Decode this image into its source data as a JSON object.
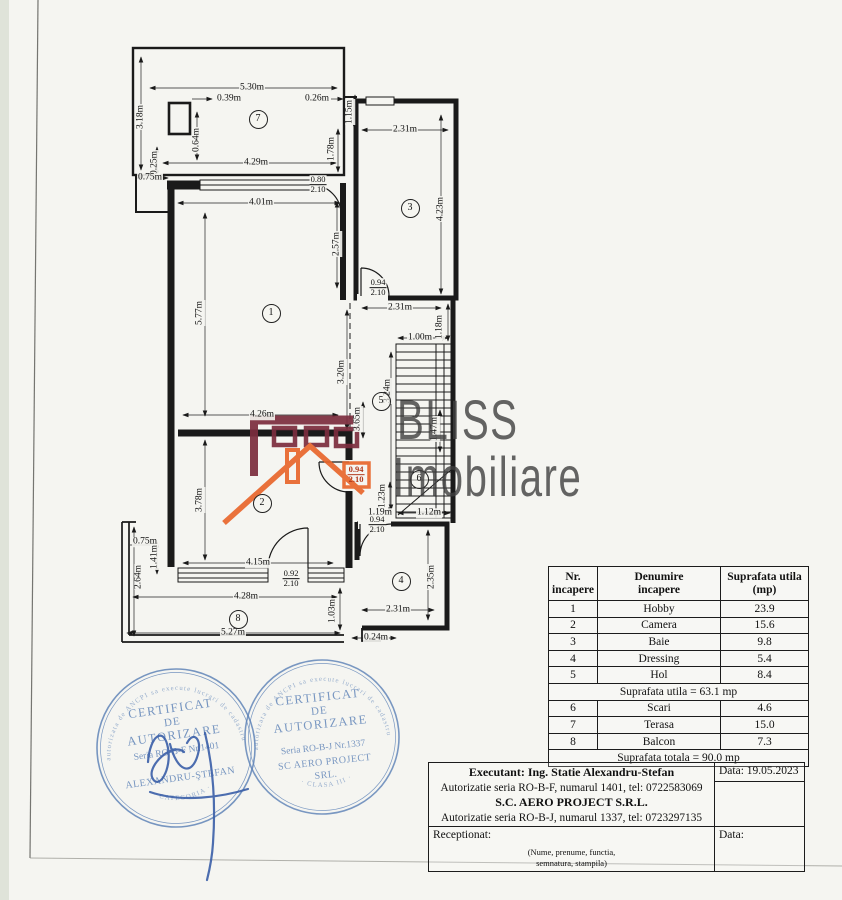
{
  "colors": {
    "ink": "#1a1a1a",
    "paper": "#f5f5f1",
    "maroon": "#7c2d3e",
    "orange": "#e8662c",
    "blue": "#5b80b6",
    "signature": "#3a5fa8"
  },
  "watermark": {
    "line1": "BLISS",
    "line2": "Imobiliare"
  },
  "plan": {
    "rooms": [
      {
        "n": "1",
        "x": 270,
        "y": 312
      },
      {
        "n": "2",
        "x": 261,
        "y": 502
      },
      {
        "n": "3",
        "x": 409,
        "y": 207
      },
      {
        "n": "4",
        "x": 400,
        "y": 580
      },
      {
        "n": "5",
        "x": 380,
        "y": 400
      },
      {
        "n": "6",
        "x": 418,
        "y": 478
      },
      {
        "n": "7",
        "x": 257,
        "y": 118
      },
      {
        "n": "8",
        "x": 237,
        "y": 618
      }
    ],
    "labels": [
      {
        "t": "5.30m",
        "x": 252,
        "y": 88
      },
      {
        "t": "0.39m",
        "x": 229,
        "y": 99
      },
      {
        "t": "0.26m",
        "x": 317,
        "y": 99
      },
      {
        "t": "1.15m",
        "x": 350,
        "y": 112,
        "r": -90
      },
      {
        "t": "3.18m",
        "x": 141,
        "y": 117,
        "r": -90
      },
      {
        "t": "0.64m",
        "x": 197,
        "y": 140,
        "r": -90
      },
      {
        "t": "1.78m",
        "x": 332,
        "y": 149,
        "r": -90
      },
      {
        "t": "0.25m",
        "x": 155,
        "y": 163,
        "r": -90
      },
      {
        "t": "4.29m",
        "x": 256,
        "y": 163
      },
      {
        "t": "0.75m",
        "x": 150,
        "y": 178
      },
      {
        "t": "4.01m",
        "x": 261,
        "y": 203
      },
      {
        "t": "2.31m",
        "x": 405,
        "y": 130
      },
      {
        "t": "4.23m",
        "x": 441,
        "y": 209,
        "r": -90
      },
      {
        "t": "2.57m",
        "x": 337,
        "y": 244,
        "r": -90
      },
      {
        "t": "5.77m",
        "x": 200,
        "y": 313,
        "r": -90
      },
      {
        "t": "2.31m",
        "x": 400,
        "y": 308
      },
      {
        "t": "1.18m",
        "x": 440,
        "y": 327,
        "r": -90
      },
      {
        "t": "1.00m",
        "x": 420,
        "y": 338
      },
      {
        "t": "3.20m",
        "x": 342,
        "y": 372,
        "r": -90
      },
      {
        "t": "3.24m",
        "x": 388,
        "y": 391,
        "r": -90
      },
      {
        "t": "3.65m",
        "x": 358,
        "y": 419,
        "r": -90
      },
      {
        "t": "1.47m",
        "x": 435,
        "y": 429,
        "r": -90
      },
      {
        "t": "4.26m",
        "x": 262,
        "y": 415
      },
      {
        "t": "3.78m",
        "x": 200,
        "y": 500,
        "r": -90
      },
      {
        "t": "1.23m",
        "x": 383,
        "y": 496,
        "r": -90
      },
      {
        "t": "1.19m",
        "x": 380,
        "y": 513
      },
      {
        "t": "1.12m",
        "x": 429,
        "y": 513
      },
      {
        "t": "4.15m",
        "x": 258,
        "y": 563
      },
      {
        "t": "2.35m",
        "x": 432,
        "y": 577,
        "r": -90
      },
      {
        "t": "0.75m",
        "x": 145,
        "y": 542
      },
      {
        "t": "1.41m",
        "x": 155,
        "y": 557,
        "r": -90
      },
      {
        "t": "2.64m",
        "x": 139,
        "y": 577,
        "r": -90
      },
      {
        "t": "4.28m",
        "x": 246,
        "y": 597
      },
      {
        "t": "1.03m",
        "x": 333,
        "y": 611,
        "r": -90
      },
      {
        "t": "2.31m",
        "x": 398,
        "y": 610
      },
      {
        "t": "5.27m",
        "x": 233,
        "y": 633
      },
      {
        "t": "0.24m",
        "x": 376,
        "y": 638
      }
    ],
    "fractions": [
      {
        "top": "0.80",
        "bottom": "2.10",
        "x": 318,
        "y": 185
      },
      {
        "top": "0.94",
        "bottom": "2.10",
        "x": 378,
        "y": 288
      },
      {
        "top": "0.94",
        "bottom": "2.10",
        "x": 377,
        "y": 525
      },
      {
        "top": "0.92",
        "bottom": "2.10",
        "x": 291,
        "y": 579
      },
      {
        "top": "0.94",
        "bottom": "2.10",
        "x": 356,
        "y": 475,
        "orange": true
      }
    ]
  },
  "table": {
    "headers": [
      "Nr.\nincapere",
      "Denumire\nincapere",
      "Suprafata utila\n(mp)"
    ],
    "rows": [
      {
        "nr": "1",
        "name": "Hobby",
        "area": "23.9"
      },
      {
        "nr": "2",
        "name": "Camera",
        "area": "15.6"
      },
      {
        "nr": "3",
        "name": "Baie",
        "area": "9.8"
      },
      {
        "nr": "4",
        "name": "Dressing",
        "area": "5.4"
      },
      {
        "nr": "5",
        "name": "Hol",
        "area": "8.4"
      },
      {
        "span": "Suprafata utila = 63.1 mp"
      },
      {
        "nr": "6",
        "name": "Scari",
        "area": "4.6"
      },
      {
        "nr": "7",
        "name": "Terasa",
        "area": "15.0"
      },
      {
        "nr": "8",
        "name": "Balcon",
        "area": "7.3"
      },
      {
        "span": "Suprafata totala = 90.0 mp"
      }
    ]
  },
  "footer": {
    "executant": "Executant: Ing. Statie Alexandru-Stefan",
    "auth1": "Autorizatie seria RO-B-F, numarul 1401, tel: 0722583069",
    "company": "S.C. AERO PROJECT S.R.L.",
    "auth2": "Autorizatie seria RO-B-J, numarul 1337, tel: 0723297135",
    "data1": "Data: 19.05.2023",
    "receptionat": "Receptionat:",
    "data2": "Data:",
    "nume": "(Nume, prenume, functia,\nsemnatura, stampila)"
  },
  "stamps": [
    {
      "arc_top": "autorizata de ANCPI sa execute lucrari de cadastru",
      "arc_bottom": "· CATEGORIA ·",
      "l1": "CERTIFICAT",
      "l2": "DE",
      "l3": "AUTORIZARE",
      "l4": "Seria RO-B-F Nr.1401",
      "l5": "ALEXANDRU-ŞTEFAN"
    },
    {
      "arc_top": "autorizata de ANCPI sa execute lucrari de cadastru",
      "arc_bottom": "· CLASA III ·",
      "l1": "CERTIFICAT",
      "l2": "DE",
      "l3": "AUTORIZARE",
      "l4": "Seria RO-B-J Nr.1337",
      "l5": "SC AERO PROJECT",
      "l6": "SRL."
    }
  ]
}
